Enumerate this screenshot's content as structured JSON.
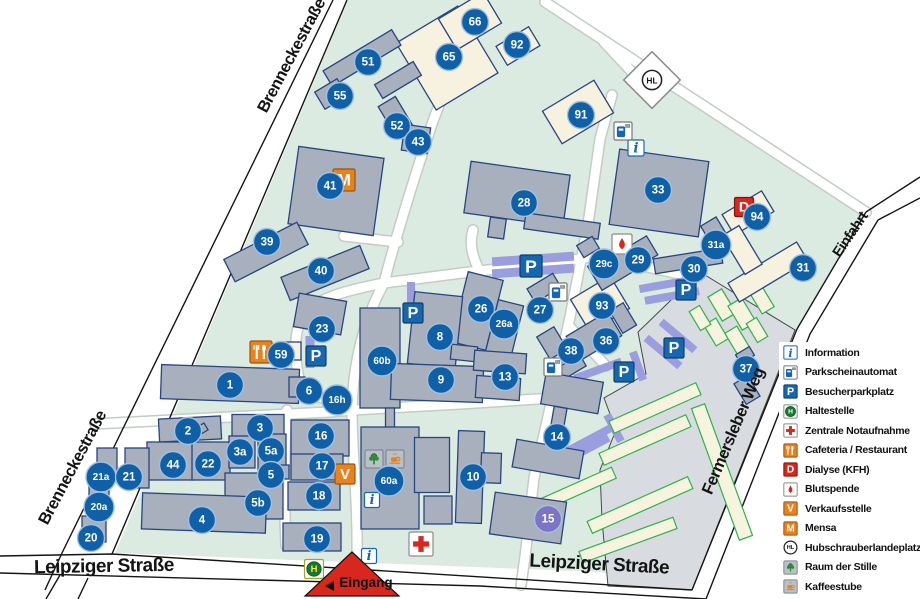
{
  "map": {
    "colors": {
      "campus": "#dcebe2",
      "parking_lot": "#d8dce0",
      "building_grey": "#a9b0bd",
      "building_cream": "#f7f2e0",
      "building_stroke": "#27457f",
      "construction_fill": "#f6f3df",
      "construction_stroke": "#2eb24a",
      "parking_strip": "#9a9ede",
      "circle_blue": "#1060a8",
      "circle_purple": "#7d74c4",
      "icon_blue": "#1767ae",
      "icon_orange": "#e8821e",
      "icon_red": "#d8271c",
      "icon_green": "#157a2e",
      "entrance_red": "#d8271c"
    },
    "street_labels": [
      {
        "text": "Brenneckestraße",
        "x": 296,
        "y": 58,
        "rotate": -62,
        "size": 16.5
      },
      {
        "text": "Brenneckestraße",
        "x": 77,
        "y": 470,
        "rotate": -62,
        "size": 16.5
      },
      {
        "text": "Leipziger Straße",
        "x": 104,
        "y": 572,
        "rotate": -1,
        "size": 19
      },
      {
        "text": "Leipziger Straße",
        "x": 599,
        "y": 570,
        "rotate": 3,
        "size": 19
      },
      {
        "text": "Einfahrt",
        "x": 854,
        "y": 237,
        "rotate": -56,
        "size": 14.5
      },
      {
        "text": "Fermersleber Weg",
        "x": 738,
        "y": 433,
        "rotate": -67,
        "size": 16.5
      }
    ],
    "entrance_label": "Eingang",
    "building_numbers": [
      {
        "id": "66",
        "x": 475,
        "y": 22
      },
      {
        "id": "92",
        "x": 517,
        "y": 45
      },
      {
        "id": "65",
        "x": 449,
        "y": 57
      },
      {
        "id": "51",
        "x": 368,
        "y": 62
      },
      {
        "id": "55",
        "x": 340,
        "y": 96
      },
      {
        "id": "52",
        "x": 397,
        "y": 126
      },
      {
        "id": "43",
        "x": 418,
        "y": 142
      },
      {
        "id": "91",
        "x": 581,
        "y": 115
      },
      {
        "id": "41",
        "x": 330,
        "y": 186
      },
      {
        "id": "28",
        "x": 524,
        "y": 203
      },
      {
        "id": "33",
        "x": 658,
        "y": 190
      },
      {
        "id": "94",
        "x": 757,
        "y": 217
      },
      {
        "id": "39",
        "x": 267,
        "y": 242
      },
      {
        "id": "40",
        "x": 321,
        "y": 271
      },
      {
        "id": "29c",
        "x": 604,
        "y": 264
      },
      {
        "id": "29",
        "x": 638,
        "y": 260
      },
      {
        "id": "31a",
        "x": 716,
        "y": 245
      },
      {
        "id": "30",
        "x": 694,
        "y": 269
      },
      {
        "id": "31",
        "x": 803,
        "y": 268
      },
      {
        "id": "23",
        "x": 322,
        "y": 329
      },
      {
        "id": "59",
        "x": 281,
        "y": 355
      },
      {
        "id": "26",
        "x": 481,
        "y": 309
      },
      {
        "id": "26a",
        "x": 504,
        "y": 324
      },
      {
        "id": "27",
        "x": 540,
        "y": 310
      },
      {
        "id": "93",
        "x": 602,
        "y": 306
      },
      {
        "id": "36",
        "x": 606,
        "y": 341
      },
      {
        "id": "38",
        "x": 571,
        "y": 351
      },
      {
        "id": "37",
        "x": 746,
        "y": 369
      },
      {
        "id": "1",
        "x": 230,
        "y": 385
      },
      {
        "id": "6",
        "x": 309,
        "y": 391
      },
      {
        "id": "16h",
        "x": 337,
        "y": 400
      },
      {
        "id": "8",
        "x": 440,
        "y": 337
      },
      {
        "id": "60b",
        "x": 382,
        "y": 361
      },
      {
        "id": "9",
        "x": 441,
        "y": 380
      },
      {
        "id": "13",
        "x": 505,
        "y": 377
      },
      {
        "id": "14",
        "x": 557,
        "y": 437
      },
      {
        "id": "2",
        "x": 188,
        "y": 431
      },
      {
        "id": "3",
        "x": 260,
        "y": 428
      },
      {
        "id": "3a",
        "x": 240,
        "y": 452
      },
      {
        "id": "5a",
        "x": 271,
        "y": 451
      },
      {
        "id": "5",
        "x": 271,
        "y": 475
      },
      {
        "id": "44",
        "x": 173,
        "y": 465
      },
      {
        "id": "22",
        "x": 208,
        "y": 464
      },
      {
        "id": "21a",
        "x": 101,
        "y": 477
      },
      {
        "id": "21",
        "x": 129,
        "y": 477
      },
      {
        "id": "20a",
        "x": 99,
        "y": 507
      },
      {
        "id": "20",
        "x": 91,
        "y": 538
      },
      {
        "id": "5b",
        "x": 258,
        "y": 503
      },
      {
        "id": "4",
        "x": 202,
        "y": 520
      },
      {
        "id": "16",
        "x": 321,
        "y": 436
      },
      {
        "id": "17",
        "x": 322,
        "y": 466
      },
      {
        "id": "18",
        "x": 319,
        "y": 496
      },
      {
        "id": "19",
        "x": 317,
        "y": 539
      },
      {
        "id": "60a",
        "x": 389,
        "y": 481
      },
      {
        "id": "10",
        "x": 473,
        "y": 477
      },
      {
        "id": "15",
        "x": 548,
        "y": 519,
        "variant": "purple"
      }
    ],
    "icons": [
      {
        "type": "mensa",
        "x": 344,
        "y": 180,
        "s": 22
      },
      {
        "type": "blutspende",
        "x": 622,
        "y": 244,
        "s": 20
      },
      {
        "type": "dialyse",
        "x": 744,
        "y": 207,
        "s": 19
      },
      {
        "type": "cafeteria",
        "x": 261,
        "y": 352,
        "s": 22
      },
      {
        "type": "verkaufsstelle",
        "x": 345,
        "y": 474,
        "s": 20
      },
      {
        "type": "raum-der-stille",
        "x": 374,
        "y": 459,
        "s": 18
      },
      {
        "type": "kaffeestube",
        "x": 395,
        "y": 459,
        "s": 18
      },
      {
        "type": "haltestelle",
        "x": 314,
        "y": 569,
        "s": 19
      },
      {
        "type": "notaufnahme",
        "x": 421,
        "y": 544,
        "s": 24
      },
      {
        "type": "hubschrauberlandeplatz",
        "x": 652,
        "y": 80,
        "s": 20
      },
      {
        "type": "information",
        "x": 636,
        "y": 148,
        "s": 16
      },
      {
        "type": "information",
        "x": 372,
        "y": 500,
        "s": 15
      },
      {
        "type": "information",
        "x": 369,
        "y": 556,
        "s": 15
      },
      {
        "type": "besucherparkplatz",
        "x": 316,
        "y": 356,
        "s": 20
      },
      {
        "type": "besucherparkplatz",
        "x": 413,
        "y": 313,
        "s": 20
      },
      {
        "type": "besucherparkplatz",
        "x": 531,
        "y": 266,
        "s": 22
      },
      {
        "type": "besucherparkplatz",
        "x": 686,
        "y": 290,
        "s": 20
      },
      {
        "type": "besucherparkplatz",
        "x": 674,
        "y": 348,
        "s": 20
      },
      {
        "type": "besucherparkplatz",
        "x": 624,
        "y": 372,
        "s": 20
      },
      {
        "type": "parkscheinautomat",
        "x": 623,
        "y": 131,
        "s": 18
      },
      {
        "type": "parkscheinautomat",
        "x": 558,
        "y": 292,
        "s": 18
      },
      {
        "type": "parkscheinautomat",
        "x": 553,
        "y": 367,
        "s": 18
      }
    ]
  },
  "legend": {
    "items": [
      {
        "icon": "information",
        "label": "Information"
      },
      {
        "icon": "parkscheinautomat",
        "label": "Parkscheinautomat"
      },
      {
        "icon": "besucherparkplatz",
        "label": "Besucherparkplatz"
      },
      {
        "icon": "haltestelle",
        "label": "Haltestelle"
      },
      {
        "icon": "notaufnahme",
        "label": "Zentrale Notaufnahme"
      },
      {
        "icon": "cafeteria",
        "label": "Cafeteria / Restaurant"
      },
      {
        "icon": "dialyse",
        "label": "Dialyse (KFH)"
      },
      {
        "icon": "blutspende",
        "label": "Blutspende"
      },
      {
        "icon": "verkaufsstelle",
        "label": "Verkaufsstelle"
      },
      {
        "icon": "mensa",
        "label": "Mensa"
      },
      {
        "icon": "hubschrauberlandeplatz",
        "label": "Hubschrauberlandeplatz"
      },
      {
        "icon": "raum-der-stille",
        "label": "Raum der Stille"
      },
      {
        "icon": "kaffeestube",
        "label": "Kaffeestube"
      }
    ]
  }
}
